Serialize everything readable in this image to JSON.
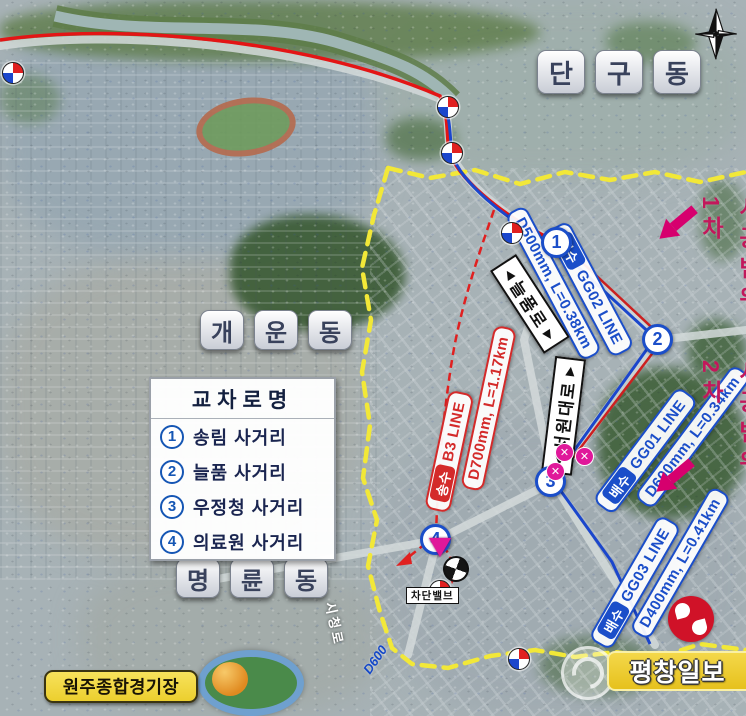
{
  "map_meta": {
    "region_labels": [
      {
        "id": "dangu",
        "name": "단구동",
        "chars": [
          "단",
          "구",
          "동"
        ]
      },
      {
        "id": "gaeun",
        "name": "개운동",
        "chars": [
          "개",
          "운",
          "동"
        ]
      },
      {
        "id": "myeongnyun",
        "name": "명륜동",
        "chars": [
          "명",
          "륜",
          "동"
        ]
      }
    ],
    "legend": {
      "title": "교차로명",
      "items": [
        {
          "num": "1",
          "label": "송림 사거리"
        },
        {
          "num": "2",
          "label": "늘품 사거리"
        },
        {
          "num": "3",
          "label": "우정청 사거리"
        },
        {
          "num": "4",
          "label": "의료원 사거리"
        }
      ]
    },
    "pipelines": [
      {
        "id": "gg02",
        "type_chip": "배수",
        "line_name": "GG02 LINE",
        "spec": "D500mm, L=0.38km",
        "color": "#1b4ec9"
      },
      {
        "id": "b3",
        "type_chip": "송수",
        "line_name": "B3 LINE",
        "spec": "D700mm, L=1.17km",
        "color": "#d42a2a"
      },
      {
        "id": "gg01",
        "type_chip": "배수",
        "line_name": "GG01 LINE",
        "spec": "D600mm, L=0.34km",
        "color": "#1b4ec9"
      },
      {
        "id": "gg03",
        "type_chip": "배수",
        "line_name": "GG03 LINE",
        "spec": "D400mm, L=0.41km",
        "color": "#1b4ec9"
      }
    ],
    "roads": [
      {
        "name": "늘품로",
        "arrow_start": "◀",
        "arrow_end": "▶"
      },
      {
        "name": "서원대로",
        "arrow_start": "◀",
        "arrow_end": "▶"
      }
    ],
    "markers": [
      {
        "num": "1"
      },
      {
        "num": "2"
      },
      {
        "num": "3"
      },
      {
        "num": "4"
      }
    ],
    "phase_notes": [
      {
        "prefix": "1차",
        "text": "시공범위"
      },
      {
        "prefix": "2차",
        "text": "시공범위"
      }
    ],
    "facility_label": "원주종합경기장",
    "valve_label": "차단밸브",
    "street_label": "시청로",
    "pipe_note": "D600",
    "watermark": {
      "text": "평창일보"
    },
    "colors": {
      "pipeline_blue": "#1b4ec9",
      "pipeline_red": "#d42a2a",
      "boundary_yellow": "#f2e838",
      "phase_pink": "#c2185b",
      "arrow_pink": "#d6006e"
    }
  }
}
